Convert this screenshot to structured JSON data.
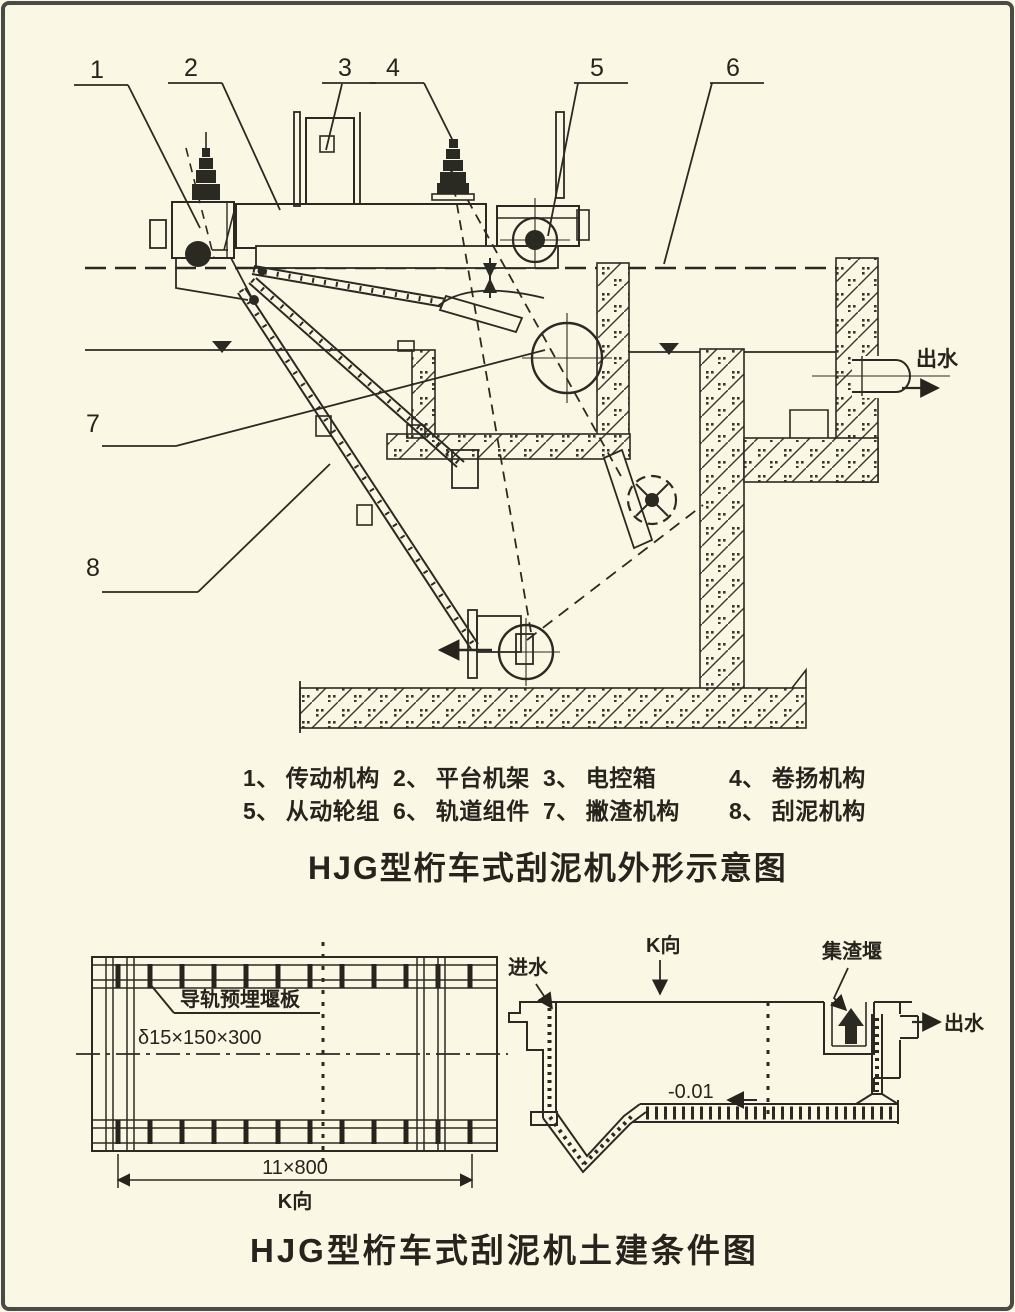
{
  "page": {
    "background": "#faf8e4",
    "ink": "#2b2a22",
    "frame_color": "#4a4a46"
  },
  "titles": {
    "main": "HJG型桁车式刮泥机外形示意图",
    "civil": "HJG型桁车式刮泥机土建条件图"
  },
  "legend": {
    "rows": [
      [
        {
          "no": "1、",
          "name": "传动机构"
        },
        {
          "no": "2、",
          "name": "平台机架"
        },
        {
          "no": "3、",
          "name": "电控箱"
        },
        {
          "no": "4、",
          "name": "卷扬机构"
        }
      ],
      [
        {
          "no": "5、",
          "name": "从动轮组"
        },
        {
          "no": "6、",
          "name": "轨道组件"
        },
        {
          "no": "7、",
          "name": "撇渣机构"
        },
        {
          "no": "8、",
          "name": "刮泥机构"
        }
      ]
    ]
  },
  "main_diagram": {
    "callouts": [
      "1",
      "2",
      "3",
      "4",
      "5",
      "6",
      "7",
      "8"
    ],
    "outlet_label": "出水"
  },
  "plan_view": {
    "note_line1": "导轨预埋堰板",
    "note_line2": "δ15×150×300",
    "dimension": "11×800",
    "direction": "K向"
  },
  "section_view": {
    "inlet_label": "进水",
    "direction": "K向",
    "scum_weir_label": "集渣堰",
    "outlet_label": "出水",
    "floor_level": "-0.01"
  }
}
